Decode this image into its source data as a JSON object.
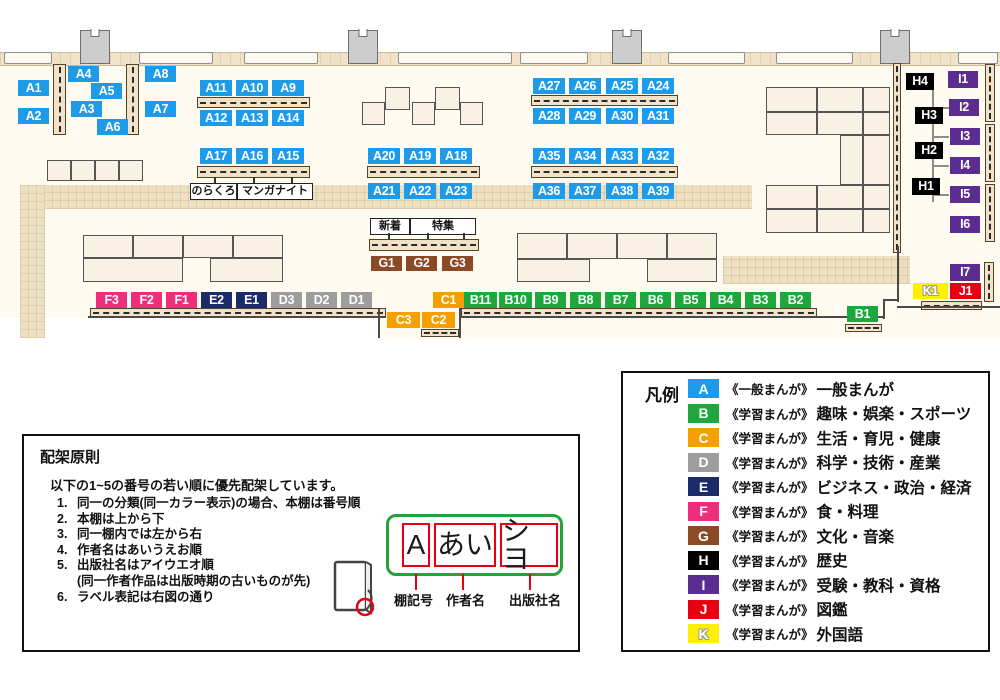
{
  "palette": {
    "A": "#1E9BE8",
    "B": "#1EA73C",
    "C": "#F6A000",
    "D": "#9D9D9E",
    "E": "#1B2A69",
    "F": "#EE2D7B",
    "G": "#8A4A26",
    "H": "#000000",
    "I": "#5B2D90",
    "J": "#E60012",
    "K": "#FFF000"
  },
  "map": {
    "floor": [
      [
        0,
        52,
        1000,
        266
      ],
      [
        380,
        318,
        620,
        22
      ]
    ],
    "wall_band": [
      0,
      52,
      1000,
      12
    ],
    "walkways": [
      [
        20,
        185,
        732,
        24
      ],
      [
        20,
        185,
        25,
        153
      ],
      [
        723,
        256,
        187,
        28
      ]
    ],
    "windows": [
      [
        4,
        52,
        48,
        12
      ],
      [
        139,
        52,
        74,
        12
      ],
      [
        244,
        52,
        74,
        12
      ],
      [
        398,
        52,
        114,
        12
      ],
      [
        520,
        52,
        68,
        12
      ],
      [
        668,
        52,
        77,
        12
      ],
      [
        776,
        52,
        77,
        12
      ],
      [
        958,
        52,
        40,
        12
      ]
    ],
    "pillars": [
      [
        80,
        30,
        30,
        34
      ],
      [
        348,
        30,
        30,
        34
      ],
      [
        612,
        30,
        30,
        34
      ],
      [
        880,
        30,
        30,
        34
      ]
    ],
    "tables": [
      [
        362,
        102,
        23,
        23
      ],
      [
        385,
        87,
        25,
        23
      ],
      [
        412,
        102,
        23,
        23
      ],
      [
        435,
        87,
        25,
        23
      ],
      [
        460,
        102,
        23,
        23
      ],
      [
        47,
        160,
        24,
        21
      ],
      [
        71,
        160,
        24,
        21
      ],
      [
        95,
        160,
        24,
        21
      ],
      [
        119,
        160,
        24,
        21
      ],
      [
        83,
        235,
        50,
        23
      ],
      [
        133,
        235,
        50,
        23
      ],
      [
        183,
        235,
        50,
        23
      ],
      [
        233,
        235,
        50,
        23
      ],
      [
        83,
        258,
        100,
        24
      ],
      [
        210,
        258,
        73,
        24
      ],
      [
        517,
        233,
        50,
        26
      ],
      [
        567,
        233,
        50,
        26
      ],
      [
        617,
        233,
        50,
        26
      ],
      [
        667,
        233,
        50,
        26
      ],
      [
        517,
        259,
        73,
        23
      ],
      [
        647,
        259,
        70,
        23
      ],
      [
        766,
        87,
        51,
        25
      ],
      [
        817,
        87,
        46,
        25
      ],
      [
        863,
        87,
        27,
        25
      ],
      [
        766,
        112,
        51,
        23
      ],
      [
        817,
        112,
        46,
        23
      ],
      [
        863,
        112,
        27,
        23
      ],
      [
        840,
        135,
        23,
        50
      ],
      [
        863,
        135,
        27,
        50
      ],
      [
        766,
        185,
        51,
        24
      ],
      [
        817,
        185,
        46,
        24
      ],
      [
        863,
        185,
        27,
        24
      ],
      [
        766,
        209,
        51,
        24
      ],
      [
        817,
        209,
        46,
        24
      ],
      [
        863,
        209,
        27,
        24
      ]
    ],
    "shelves_h": [
      [
        197,
        97,
        113,
        11
      ],
      [
        197,
        166,
        113,
        12
      ],
      [
        367,
        166,
        113,
        12
      ],
      [
        531,
        95,
        147,
        11
      ],
      [
        531,
        166,
        147,
        12
      ],
      [
        369,
        239,
        110,
        12
      ],
      [
        90,
        308,
        296,
        9
      ],
      [
        461,
        308,
        356,
        9
      ],
      [
        421,
        329,
        38,
        8
      ],
      [
        845,
        324,
        37,
        8
      ],
      [
        921,
        301,
        61,
        9
      ]
    ],
    "shelves_v": [
      [
        53,
        64,
        13,
        71
      ],
      [
        126,
        64,
        13,
        71
      ],
      [
        893,
        63,
        8,
        190
      ],
      [
        985,
        64,
        10,
        58
      ],
      [
        985,
        124,
        10,
        58
      ],
      [
        985,
        184,
        10,
        58
      ],
      [
        984,
        262,
        10,
        40
      ]
    ],
    "wall_lines": [
      [
        88,
        316,
        298,
        2
      ],
      [
        460,
        316,
        424,
        2
      ],
      [
        378,
        308,
        2,
        30
      ],
      [
        459,
        308,
        2,
        30
      ],
      [
        883,
        299,
        2,
        20
      ],
      [
        883,
        299,
        16,
        2
      ],
      [
        897,
        246,
        2,
        56
      ],
      [
        897,
        306,
        103,
        2
      ]
    ],
    "connector_lines": [
      [
        932,
        84,
        2,
        118
      ],
      [
        932,
        107,
        17,
        2
      ],
      [
        932,
        136,
        17,
        2
      ],
      [
        932,
        165,
        17,
        2
      ],
      [
        932,
        194,
        17,
        2
      ]
    ],
    "chips": [
      {
        "t": "A1",
        "c": "A",
        "x": 18,
        "y": 80
      },
      {
        "t": "A2",
        "c": "A",
        "x": 18,
        "y": 108
      },
      {
        "t": "A4",
        "c": "A",
        "x": 68,
        "y": 66
      },
      {
        "t": "A5",
        "c": "A",
        "x": 91,
        "y": 83
      },
      {
        "t": "A3",
        "c": "A",
        "x": 71,
        "y": 101
      },
      {
        "t": "A6",
        "c": "A",
        "x": 97,
        "y": 119
      },
      {
        "t": "A8",
        "c": "A",
        "x": 145,
        "y": 66
      },
      {
        "t": "A7",
        "c": "A",
        "x": 145,
        "y": 101
      },
      {
        "t": "A11",
        "c": "A",
        "x": 200,
        "y": 80,
        "w": 32
      },
      {
        "t": "A10",
        "c": "A",
        "x": 236,
        "y": 80,
        "w": 32
      },
      {
        "t": "A9",
        "c": "A",
        "x": 272,
        "y": 80,
        "w": 32
      },
      {
        "t": "A12",
        "c": "A",
        "x": 200,
        "y": 110,
        "w": 32
      },
      {
        "t": "A13",
        "c": "A",
        "x": 236,
        "y": 110,
        "w": 32
      },
      {
        "t": "A14",
        "c": "A",
        "x": 272,
        "y": 110,
        "w": 32
      },
      {
        "t": "A17",
        "c": "A",
        "x": 200,
        "y": 148,
        "w": 32
      },
      {
        "t": "A16",
        "c": "A",
        "x": 236,
        "y": 148,
        "w": 32
      },
      {
        "t": "A15",
        "c": "A",
        "x": 272,
        "y": 148,
        "w": 32
      },
      {
        "t": "A20",
        "c": "A",
        "x": 368,
        "y": 148,
        "w": 32
      },
      {
        "t": "A19",
        "c": "A",
        "x": 404,
        "y": 148,
        "w": 32
      },
      {
        "t": "A18",
        "c": "A",
        "x": 440,
        "y": 148,
        "w": 32
      },
      {
        "t": "A21",
        "c": "A",
        "x": 368,
        "y": 183,
        "w": 32
      },
      {
        "t": "A22",
        "c": "A",
        "x": 404,
        "y": 183,
        "w": 32
      },
      {
        "t": "A23",
        "c": "A",
        "x": 440,
        "y": 183,
        "w": 32
      },
      {
        "t": "A27",
        "c": "A",
        "x": 533,
        "y": 78,
        "w": 32
      },
      {
        "t": "A26",
        "c": "A",
        "x": 569,
        "y": 78,
        "w": 32
      },
      {
        "t": "A25",
        "c": "A",
        "x": 606,
        "y": 78,
        "w": 32
      },
      {
        "t": "A24",
        "c": "A",
        "x": 642,
        "y": 78,
        "w": 32
      },
      {
        "t": "A28",
        "c": "A",
        "x": 533,
        "y": 108,
        "w": 32
      },
      {
        "t": "A29",
        "c": "A",
        "x": 569,
        "y": 108,
        "w": 32
      },
      {
        "t": "A30",
        "c": "A",
        "x": 606,
        "y": 108,
        "w": 32
      },
      {
        "t": "A31",
        "c": "A",
        "x": 642,
        "y": 108,
        "w": 32
      },
      {
        "t": "A35",
        "c": "A",
        "x": 533,
        "y": 148,
        "w": 32
      },
      {
        "t": "A34",
        "c": "A",
        "x": 569,
        "y": 148,
        "w": 32
      },
      {
        "t": "A33",
        "c": "A",
        "x": 606,
        "y": 148,
        "w": 32
      },
      {
        "t": "A32",
        "c": "A",
        "x": 642,
        "y": 148,
        "w": 32
      },
      {
        "t": "A36",
        "c": "A",
        "x": 533,
        "y": 183,
        "w": 32
      },
      {
        "t": "A37",
        "c": "A",
        "x": 569,
        "y": 183,
        "w": 32
      },
      {
        "t": "A38",
        "c": "A",
        "x": 606,
        "y": 183,
        "w": 32
      },
      {
        "t": "A39",
        "c": "A",
        "x": 642,
        "y": 183,
        "w": 32
      },
      {
        "t": "G1",
        "c": "G",
        "x": 371,
        "y": 256,
        "h": 15
      },
      {
        "t": "G2",
        "c": "G",
        "x": 406,
        "y": 256,
        "h": 15
      },
      {
        "t": "G3",
        "c": "G",
        "x": 442,
        "y": 256,
        "h": 15
      },
      {
        "t": "F3",
        "c": "F",
        "x": 96,
        "y": 292
      },
      {
        "t": "F2",
        "c": "F",
        "x": 131,
        "y": 292
      },
      {
        "t": "F1",
        "c": "F",
        "x": 166,
        "y": 292
      },
      {
        "t": "E2",
        "c": "E",
        "x": 201,
        "y": 292
      },
      {
        "t": "E1",
        "c": "E",
        "x": 236,
        "y": 292
      },
      {
        "t": "D3",
        "c": "D",
        "x": 271,
        "y": 292
      },
      {
        "t": "D2",
        "c": "D",
        "x": 306,
        "y": 292
      },
      {
        "t": "D1",
        "c": "D",
        "x": 341,
        "y": 292
      },
      {
        "t": "C1",
        "c": "C",
        "x": 433,
        "y": 292
      },
      {
        "t": "B11",
        "c": "B",
        "x": 464,
        "y": 292,
        "w": 33
      },
      {
        "t": "B10",
        "c": "B",
        "x": 499,
        "y": 292,
        "w": 33
      },
      {
        "t": "B9",
        "c": "B",
        "x": 535,
        "y": 292
      },
      {
        "t": "B8",
        "c": "B",
        "x": 570,
        "y": 292
      },
      {
        "t": "B7",
        "c": "B",
        "x": 605,
        "y": 292
      },
      {
        "t": "B6",
        "c": "B",
        "x": 640,
        "y": 292
      },
      {
        "t": "B5",
        "c": "B",
        "x": 675,
        "y": 292
      },
      {
        "t": "B4",
        "c": "B",
        "x": 710,
        "y": 292
      },
      {
        "t": "B3",
        "c": "B",
        "x": 745,
        "y": 292
      },
      {
        "t": "B2",
        "c": "B",
        "x": 780,
        "y": 292
      },
      {
        "t": "C3",
        "c": "C",
        "x": 387,
        "y": 312,
        "w": 33
      },
      {
        "t": "C2",
        "c": "C",
        "x": 422,
        "y": 312,
        "w": 33
      },
      {
        "t": "B1",
        "c": "B",
        "x": 847,
        "y": 306
      },
      {
        "t": "H4",
        "c": "H",
        "x": 906,
        "y": 73,
        "w": 28,
        "h": 17
      },
      {
        "t": "H3",
        "c": "H",
        "x": 915,
        "y": 107,
        "w": 28,
        "h": 17
      },
      {
        "t": "H2",
        "c": "H",
        "x": 915,
        "y": 142,
        "w": 28,
        "h": 17
      },
      {
        "t": "H1",
        "c": "H",
        "x": 912,
        "y": 178,
        "w": 28,
        "h": 17
      },
      {
        "t": "I1",
        "c": "I",
        "x": 948,
        "y": 71,
        "w": 30,
        "h": 17
      },
      {
        "t": "I2",
        "c": "I",
        "x": 949,
        "y": 99,
        "w": 30,
        "h": 17
      },
      {
        "t": "I3",
        "c": "I",
        "x": 950,
        "y": 128,
        "w": 30,
        "h": 17
      },
      {
        "t": "I4",
        "c": "I",
        "x": 950,
        "y": 157,
        "w": 30,
        "h": 17
      },
      {
        "t": "I5",
        "c": "I",
        "x": 950,
        "y": 186,
        "w": 30,
        "h": 17
      },
      {
        "t": "I6",
        "c": "I",
        "x": 950,
        "y": 216,
        "w": 30,
        "h": 17
      },
      {
        "t": "I7",
        "c": "I",
        "x": 950,
        "y": 264,
        "w": 30,
        "h": 17
      },
      {
        "t": "K1",
        "c": "K",
        "x": 913,
        "y": 283,
        "w": 35,
        "h": 16
      },
      {
        "t": "J1",
        "c": "J",
        "x": 950,
        "y": 283,
        "w": 31,
        "h": 16
      }
    ],
    "annotations": [
      {
        "t": "のらくろ",
        "x": 190,
        "y": 183,
        "w": 45,
        "h": 15
      },
      {
        "t": "マンガナイト",
        "x": 237,
        "y": 183,
        "w": 74,
        "h": 15
      },
      {
        "t": "新着",
        "x": 370,
        "y": 218,
        "w": 38,
        "h": 15
      },
      {
        "t": "特集",
        "x": 410,
        "y": 218,
        "w": 64,
        "h": 15
      }
    ],
    "ticks": [
      [
        214,
        177,
        6
      ],
      [
        253,
        177,
        6
      ],
      [
        291,
        177,
        6
      ],
      [
        388,
        233,
        6
      ],
      [
        427,
        233,
        6
      ],
      [
        463,
        233,
        6
      ]
    ]
  },
  "legend": {
    "title": "凡例",
    "rows": [
      {
        "letter": "A",
        "series": "《一般まんが》",
        "category": "一般まんが"
      },
      {
        "letter": "B",
        "series": "《学習まんが》",
        "category": "趣味・娯楽・スポーツ"
      },
      {
        "letter": "C",
        "series": "《学習まんが》",
        "category": "生活・育児・健康"
      },
      {
        "letter": "D",
        "series": "《学習まんが》",
        "category": "科学・技術・産業"
      },
      {
        "letter": "E",
        "series": "《学習まんが》",
        "category": "ビジネス・政治・経済"
      },
      {
        "letter": "F",
        "series": "《学習まんが》",
        "category": "食・料理"
      },
      {
        "letter": "G",
        "series": "《学習まんが》",
        "category": "文化・音楽"
      },
      {
        "letter": "H",
        "series": "《学習まんが》",
        "category": "歴史"
      },
      {
        "letter": "I",
        "series": "《学習まんが》",
        "category": "受験・教科・資格"
      },
      {
        "letter": "J",
        "series": "《学習まんが》",
        "category": "図鑑"
      },
      {
        "letter": "K",
        "series": "《学習まんが》",
        "category": "外国語"
      }
    ]
  },
  "principles": {
    "title": "配架原則",
    "intro": "以下の1~5の番号の若い順に優先配架しています。",
    "items": [
      {
        "num": "1.",
        "text": "同一の分類(同一カラー表示)の場合、本棚は番号順"
      },
      {
        "num": "2.",
        "text": "本棚は上から下"
      },
      {
        "num": "3.",
        "text": "同一棚内では左から右"
      },
      {
        "num": "4.",
        "text": "作者名はあいうえお順"
      },
      {
        "num": "5.",
        "text": "出版社名はアイウエオ順"
      },
      {
        "num": "",
        "text": "(同一作者作品は出版時期の古いものが先)"
      },
      {
        "num": "6.",
        "text": "ラベル表記は右図の通り"
      }
    ]
  },
  "label_example": {
    "shelf_code": "A",
    "author": "あい",
    "publisher": "シヨ",
    "caption_shelf": "棚記号",
    "caption_author": "作者名",
    "caption_publisher": "出版社名"
  }
}
